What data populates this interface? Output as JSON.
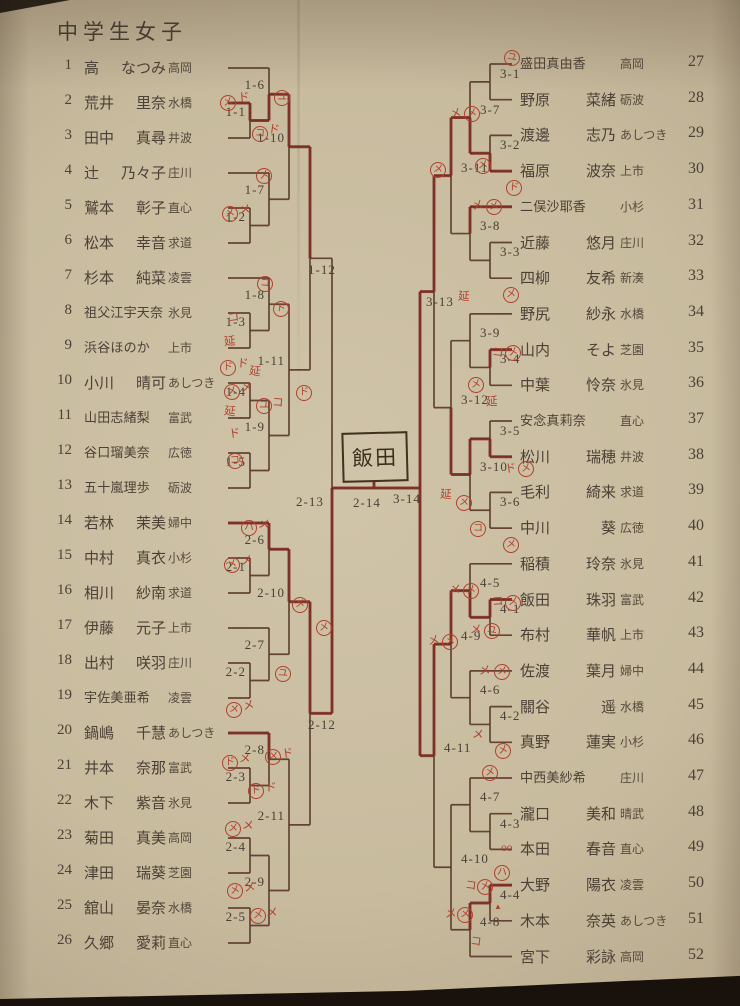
{
  "title": "中学生女子",
  "winner_box": "飯田",
  "colors": {
    "paper": "#c8bb9e",
    "line": "#5a392b",
    "trace": "#7e2b22",
    "ink": "#4b4136",
    "red_ink": "#b0402e"
  },
  "players_left": [
    {
      "n": "1",
      "name": "高　なつみ",
      "club": "高岡"
    },
    {
      "n": "2",
      "name": "荒井　里奈",
      "club": "水橋"
    },
    {
      "n": "3",
      "name": "田中　真尋",
      "club": "井波"
    },
    {
      "n": "4",
      "name": "辻　乃々子",
      "club": "庄川"
    },
    {
      "n": "5",
      "name": "鷲本　彰子",
      "club": "直心"
    },
    {
      "n": "6",
      "name": "松本　幸音",
      "club": "求道"
    },
    {
      "n": "7",
      "name": "杉本　純菜",
      "club": "凌雲"
    },
    {
      "n": "8",
      "name": "祖父江宇天奈",
      "club": "氷見"
    },
    {
      "n": "9",
      "name": "浜谷ほのか",
      "club": "上市"
    },
    {
      "n": "10",
      "name": "小川　晴可",
      "club": "あしつき"
    },
    {
      "n": "11",
      "name": "山田志緒梨",
      "club": "富武"
    },
    {
      "n": "12",
      "name": "谷口瑠美奈",
      "club": "広徳"
    },
    {
      "n": "13",
      "name": "五十嵐理歩",
      "club": "砺波"
    },
    {
      "n": "14",
      "name": "若林　茉美",
      "club": "婦中"
    },
    {
      "n": "15",
      "name": "中村　真衣",
      "club": "小杉"
    },
    {
      "n": "16",
      "name": "相川　紗南",
      "club": "求道"
    },
    {
      "n": "17",
      "name": "伊藤　元子",
      "club": "上市"
    },
    {
      "n": "18",
      "name": "出村　咲羽",
      "club": "庄川"
    },
    {
      "n": "19",
      "name": "宇佐美亜希",
      "club": "凌雲"
    },
    {
      "n": "20",
      "name": "鍋嶋　千慧",
      "club": "あしつき"
    },
    {
      "n": "21",
      "name": "井本　奈那",
      "club": "富武"
    },
    {
      "n": "22",
      "name": "木下　紫音",
      "club": "氷見"
    },
    {
      "n": "23",
      "name": "菊田　真美",
      "club": "高岡"
    },
    {
      "n": "24",
      "name": "津田　瑞葵",
      "club": "芝園"
    },
    {
      "n": "25",
      "name": "舘山　晏奈",
      "club": "水橋"
    },
    {
      "n": "26",
      "name": "久郷　愛莉",
      "club": "直心"
    }
  ],
  "players_right": [
    {
      "n": "27",
      "name": "盛田真由香",
      "club": "高岡"
    },
    {
      "n": "28",
      "name": "野原　菜緒",
      "club": "砺波"
    },
    {
      "n": "29",
      "name": "渡邊　志乃",
      "club": "あしつき"
    },
    {
      "n": "30",
      "name": "福原　波奈",
      "club": "上市"
    },
    {
      "n": "31",
      "name": "二俣沙耶香",
      "club": "小杉"
    },
    {
      "n": "32",
      "name": "近藤　悠月",
      "club": "庄川"
    },
    {
      "n": "33",
      "name": "四柳　友希",
      "club": "新湊"
    },
    {
      "n": "34",
      "name": "野尻　紗永",
      "club": "水橋"
    },
    {
      "n": "35",
      "name": "山内　そよ",
      "club": "芝園"
    },
    {
      "n": "36",
      "name": "中葉　怜奈",
      "club": "氷見"
    },
    {
      "n": "37",
      "name": "安念真莉奈",
      "club": "直心"
    },
    {
      "n": "38",
      "name": "松川　瑞穂",
      "club": "井波"
    },
    {
      "n": "39",
      "name": "毛利　綺来",
      "club": "求道"
    },
    {
      "n": "40",
      "name": "中川　葵",
      "club": "広徳"
    },
    {
      "n": "41",
      "name": "稲積　玲奈",
      "club": "氷見"
    },
    {
      "n": "42",
      "name": "飯田　珠羽",
      "club": "富武"
    },
    {
      "n": "43",
      "name": "布村　華帆",
      "club": "上市"
    },
    {
      "n": "44",
      "name": "佐渡　葉月",
      "club": "婦中"
    },
    {
      "n": "45",
      "name": "關谷　遥",
      "club": "水橋"
    },
    {
      "n": "46",
      "name": "真野　蓮実",
      "club": "小杉"
    },
    {
      "n": "47",
      "name": "中西美紗希",
      "club": "庄川"
    },
    {
      "n": "48",
      "name": "瀧口　美和",
      "club": "晴武"
    },
    {
      "n": "49",
      "name": "本田　春音",
      "club": "直心"
    },
    {
      "n": "50",
      "name": "大野　陽衣",
      "club": "凌雲"
    },
    {
      "n": "51",
      "name": "木本　奈英",
      "club": "あしつき"
    },
    {
      "n": "52",
      "name": "宮下　彩詠",
      "club": "高岡"
    }
  ],
  "bracket": {
    "left_matches": [
      {
        "id": "1-1",
        "r": 1,
        "a": "p2",
        "b": "p3"
      },
      {
        "id": "1-2",
        "r": 1,
        "a": "p5",
        "b": "p6"
      },
      {
        "id": "1-3",
        "r": 1,
        "a": "p8",
        "b": "p9"
      },
      {
        "id": "1-4",
        "r": 1,
        "a": "p10",
        "b": "p11"
      },
      {
        "id": "1-5",
        "r": 1,
        "a": "p12",
        "b": "p13"
      },
      {
        "id": "2-1",
        "r": 1,
        "a": "p15",
        "b": "p16"
      },
      {
        "id": "2-2",
        "r": 1,
        "a": "p18",
        "b": "p19"
      },
      {
        "id": "2-3",
        "r": 1,
        "a": "p21",
        "b": "p22"
      },
      {
        "id": "2-4",
        "r": 1,
        "a": "p23",
        "b": "p24"
      },
      {
        "id": "2-5",
        "r": 1,
        "a": "p25",
        "b": "p26"
      },
      {
        "id": "1-6",
        "r": 2,
        "a": "p1",
        "b": "1-1"
      },
      {
        "id": "1-7",
        "r": 2,
        "a": "p4",
        "b": "1-2"
      },
      {
        "id": "1-8",
        "r": 2,
        "a": "p7",
        "b": "1-3"
      },
      {
        "id": "1-9",
        "r": 2,
        "a": "1-4",
        "b": "1-5"
      },
      {
        "id": "2-6",
        "r": 2,
        "a": "p14",
        "b": "2-1"
      },
      {
        "id": "2-7",
        "r": 2,
        "a": "p17",
        "b": "2-2"
      },
      {
        "id": "2-8",
        "r": 2,
        "a": "p20",
        "b": "2-3"
      },
      {
        "id": "2-9",
        "r": 2,
        "a": "2-4",
        "b": "2-5"
      },
      {
        "id": "1-10",
        "r": 3,
        "a": "1-6",
        "b": "1-7"
      },
      {
        "id": "1-11",
        "r": 3,
        "a": "1-8",
        "b": "1-9"
      },
      {
        "id": "2-10",
        "r": 3,
        "a": "2-6",
        "b": "2-7"
      },
      {
        "id": "2-11",
        "r": 3,
        "a": "2-8",
        "b": "2-9"
      },
      {
        "id": "1-12",
        "r": 4,
        "a": "1-10",
        "b": "1-11"
      },
      {
        "id": "2-12",
        "r": 4,
        "a": "2-10",
        "b": "2-11"
      },
      {
        "id": "2-13",
        "r": 5,
        "a": "1-12",
        "b": "2-12"
      }
    ],
    "right_matches": [
      {
        "id": "3-1",
        "r": 1,
        "a": "p27",
        "b": "p28"
      },
      {
        "id": "3-2",
        "r": 1,
        "a": "p29",
        "b": "p30"
      },
      {
        "id": "3-3",
        "r": 1,
        "a": "p32",
        "b": "p33"
      },
      {
        "id": "3-4",
        "r": 1,
        "a": "p35",
        "b": "p36"
      },
      {
        "id": "3-5",
        "r": 1,
        "a": "p37",
        "b": "p38"
      },
      {
        "id": "3-6",
        "r": 1,
        "a": "p39",
        "b": "p40"
      },
      {
        "id": "4-1",
        "r": 1,
        "a": "p42",
        "b": "p43"
      },
      {
        "id": "4-2",
        "r": 1,
        "a": "p45",
        "b": "p46"
      },
      {
        "id": "4-3",
        "r": 1,
        "a": "p48",
        "b": "p49"
      },
      {
        "id": "4-4",
        "r": 1,
        "a": "p50",
        "b": "p51"
      },
      {
        "id": "3-7",
        "r": 2,
        "a": "3-1",
        "b": "3-2"
      },
      {
        "id": "3-8",
        "r": 2,
        "a": "p31",
        "b": "3-3"
      },
      {
        "id": "3-9",
        "r": 2,
        "a": "p34",
        "b": "3-4"
      },
      {
        "id": "3-10",
        "r": 2,
        "a": "3-5",
        "b": "3-6"
      },
      {
        "id": "4-5",
        "r": 2,
        "a": "p41",
        "b": "4-1"
      },
      {
        "id": "4-6",
        "r": 2,
        "a": "p44",
        "b": "4-2"
      },
      {
        "id": "4-7",
        "r": 2,
        "a": "p47",
        "b": "4-3"
      },
      {
        "id": "4-8",
        "r": 2,
        "a": "4-4",
        "b": "p52"
      },
      {
        "id": "3-11",
        "r": 3,
        "a": "3-7",
        "b": "3-8"
      },
      {
        "id": "3-12",
        "r": 3,
        "a": "3-9",
        "b": "3-10"
      },
      {
        "id": "4-9",
        "r": 3,
        "a": "4-5",
        "b": "4-6"
      },
      {
        "id": "4-10",
        "r": 3,
        "a": "4-7",
        "b": "4-8"
      },
      {
        "id": "3-13",
        "r": 4,
        "a": "3-11",
        "b": "3-12"
      },
      {
        "id": "4-11",
        "r": 4,
        "a": "4-9",
        "b": "4-10"
      },
      {
        "id": "3-14",
        "r": 5,
        "a": "3-13",
        "b": "4-11"
      }
    ],
    "final_label": "2-14",
    "right_final_label": "3-14"
  },
  "traces": [
    [
      "p2",
      "1-1",
      "1-6",
      "1-10",
      "1-12"
    ],
    [
      "p14",
      "2-6",
      "2-10",
      "2-12",
      "2-13",
      "F"
    ],
    [
      "p20",
      "2-8"
    ],
    [
      "p30",
      "3-2",
      "3-7",
      "3-11",
      "3-13",
      "3-14"
    ],
    [
      "p31",
      "3-8"
    ],
    [
      "p35",
      "3-4"
    ],
    [
      "p38",
      "3-5",
      "3-10",
      "3-12"
    ],
    [
      "p50",
      "4-4",
      "4-8"
    ],
    [
      "p42",
      "4-1",
      "4-5",
      "4-9",
      "4-11",
      "3-14",
      "F",
      "W"
    ]
  ],
  "annotations": [
    {
      "t": "メ",
      "c": 1,
      "x": 220,
      "y": 95
    },
    {
      "t": "ド",
      "x": 238,
      "y": 92
    },
    {
      "t": "ユ",
      "c": 1,
      "x": 274,
      "y": 90
    },
    {
      "t": "コ",
      "c": 1,
      "x": 252,
      "y": 126
    },
    {
      "t": "ド",
      "x": 268,
      "y": 124
    },
    {
      "t": "メ",
      "c": 1,
      "x": 256,
      "y": 168
    },
    {
      "t": "メ",
      "c": 1,
      "x": 222,
      "y": 206
    },
    {
      "t": "メ",
      "x": 239,
      "y": 204
    },
    {
      "t": "コ",
      "c": 1,
      "x": 257,
      "y": 276
    },
    {
      "t": "ド",
      "c": 1,
      "x": 273,
      "y": 301
    },
    {
      "t": "コ",
      "x": 228,
      "y": 312
    },
    {
      "t": "延",
      "x": 224,
      "y": 336
    },
    {
      "t": "ド",
      "c": 1,
      "x": 220,
      "y": 360
    },
    {
      "t": "ド",
      "x": 237,
      "y": 358
    },
    {
      "t": "延",
      "x": 249,
      "y": 366
    },
    {
      "t": "メ",
      "c": 1,
      "x": 224,
      "y": 384
    },
    {
      "t": "メ",
      "x": 241,
      "y": 382
    },
    {
      "t": "ユ",
      "c": 1,
      "x": 256,
      "y": 398
    },
    {
      "t": "コ",
      "x": 272,
      "y": 397
    },
    {
      "t": "延",
      "x": 224,
      "y": 406
    },
    {
      "t": "ド",
      "x": 229,
      "y": 428
    },
    {
      "t": "コ",
      "c": 1,
      "x": 227,
      "y": 453
    },
    {
      "t": "ド",
      "c": 1,
      "x": 296,
      "y": 385
    },
    {
      "t": "ハ",
      "c": 1,
      "x": 241,
      "y": 520
    },
    {
      "t": "メ",
      "x": 258,
      "y": 519
    },
    {
      "t": "メ",
      "c": 1,
      "x": 224,
      "y": 557
    },
    {
      "t": "メ",
      "x": 241,
      "y": 555
    },
    {
      "t": "メ",
      "c": 1,
      "x": 292,
      "y": 597
    },
    {
      "t": "ユ",
      "c": 1,
      "x": 275,
      "y": 666
    },
    {
      "t": "メ",
      "c": 1,
      "x": 226,
      "y": 702
    },
    {
      "t": "メ",
      "x": 243,
      "y": 700
    },
    {
      "t": "メ",
      "c": 1,
      "x": 316,
      "y": 620
    },
    {
      "t": "ド",
      "c": 1,
      "x": 222,
      "y": 755
    },
    {
      "t": "メ",
      "x": 239,
      "y": 753
    },
    {
      "t": "メ",
      "c": 1,
      "x": 265,
      "y": 749
    },
    {
      "t": "ド",
      "x": 282,
      "y": 748
    },
    {
      "t": "ド",
      "c": 1,
      "x": 248,
      "y": 783
    },
    {
      "t": "ド",
      "x": 265,
      "y": 782
    },
    {
      "t": "メ",
      "c": 1,
      "x": 225,
      "y": 821
    },
    {
      "t": "メ",
      "x": 242,
      "y": 820
    },
    {
      "t": "メ",
      "c": 1,
      "x": 227,
      "y": 883
    },
    {
      "t": "メ",
      "x": 244,
      "y": 882
    },
    {
      "t": "メ",
      "c": 1,
      "x": 250,
      "y": 908
    },
    {
      "t": "メ",
      "x": 266,
      "y": 907
    },
    {
      "t": "ユ",
      "c": 1,
      "x": 504,
      "y": 50
    },
    {
      "t": "メ",
      "x": 450,
      "y": 108
    },
    {
      "t": "メ",
      "c": 1,
      "x": 464,
      "y": 106
    },
    {
      "t": "メ",
      "c": 1,
      "x": 475,
      "y": 158
    },
    {
      "t": "ド",
      "c": 1,
      "x": 506,
      "y": 180
    },
    {
      "t": "メ",
      "c": 1,
      "x": 430,
      "y": 162
    },
    {
      "t": "メ",
      "x": 472,
      "y": 200
    },
    {
      "t": "メ",
      "c": 1,
      "x": 486,
      "y": 199
    },
    {
      "t": "メ",
      "c": 1,
      "x": 503,
      "y": 287
    },
    {
      "t": "延",
      "x": 458,
      "y": 291
    },
    {
      "t": "コ",
      "x": 492,
      "y": 347
    },
    {
      "t": "メ",
      "c": 1,
      "x": 505,
      "y": 345
    },
    {
      "t": "メ",
      "c": 1,
      "x": 468,
      "y": 377
    },
    {
      "t": "延",
      "x": 486,
      "y": 396
    },
    {
      "t": "延",
      "x": 440,
      "y": 489
    },
    {
      "t": "メ",
      "c": 1,
      "x": 456,
      "y": 495
    },
    {
      "t": "ド",
      "x": 505,
      "y": 463
    },
    {
      "t": "メ",
      "c": 1,
      "x": 518,
      "y": 461
    },
    {
      "t": "コ",
      "c": 1,
      "x": 470,
      "y": 521
    },
    {
      "t": "メ",
      "c": 1,
      "x": 503,
      "y": 537
    },
    {
      "t": "メ",
      "x": 449,
      "y": 584
    },
    {
      "t": "メ",
      "c": 1,
      "x": 463,
      "y": 583
    },
    {
      "t": "コ",
      "x": 492,
      "y": 596
    },
    {
      "t": "メ",
      "c": 1,
      "x": 505,
      "y": 595
    },
    {
      "t": "メ",
      "x": 470,
      "y": 624
    },
    {
      "t": "ユ",
      "c": 1,
      "x": 484,
      "y": 623
    },
    {
      "t": "メ",
      "x": 428,
      "y": 635
    },
    {
      "t": "メ",
      "c": 1,
      "x": 442,
      "y": 634
    },
    {
      "t": "メ",
      "x": 479,
      "y": 665
    },
    {
      "t": "メ",
      "c": 1,
      "x": 494,
      "y": 664
    },
    {
      "t": "メ",
      "x": 472,
      "y": 729
    },
    {
      "t": "メ",
      "c": 1,
      "x": 495,
      "y": 743
    },
    {
      "t": "メ",
      "c": 1,
      "x": 482,
      "y": 765
    },
    {
      "t": "oo",
      "x": 501,
      "y": 842
    },
    {
      "t": "ハ",
      "c": 1,
      "x": 494,
      "y": 865
    },
    {
      "t": "コ",
      "x": 465,
      "y": 880
    },
    {
      "t": "メ",
      "c": 1,
      "x": 477,
      "y": 879
    },
    {
      "t": "▲",
      "s": 1,
      "x": 494,
      "y": 900
    },
    {
      "t": "メ",
      "x": 445,
      "y": 908
    },
    {
      "t": "メ",
      "c": 1,
      "x": 457,
      "y": 907
    },
    {
      "t": "コ",
      "x": 470,
      "y": 936
    }
  ]
}
